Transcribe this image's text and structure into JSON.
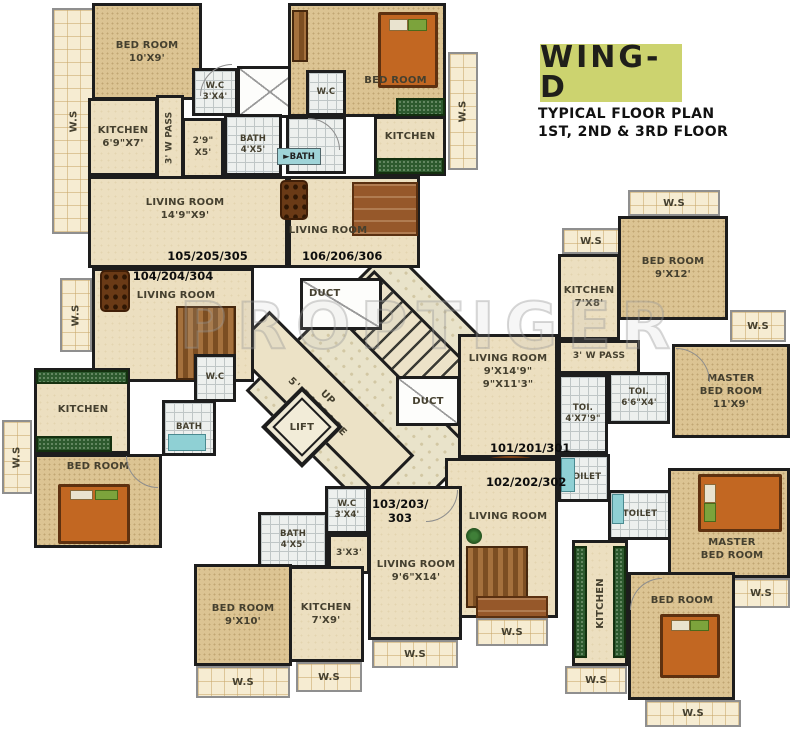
{
  "title": {
    "wing": "WING-D",
    "subtitle1": "TYPICAL FLOOR PLAN",
    "subtitle2": "1ST, 2ND & 3RD FLOOR",
    "accent_color": "#ccd36f"
  },
  "watermark": "PROPTIGER",
  "common": {
    "ws": "W.S"
  },
  "core": {
    "duct": "DUCT",
    "up": "UP",
    "passage": "5' PASSAGE",
    "lift": "LIFT"
  },
  "units": {
    "u105": {
      "id": "105/205/305",
      "bedroom": "BED ROOM\n10'X9'",
      "kitchen": "KITCHEN\n6'9\"X7'",
      "wpass": "3' W PASS",
      "store": "2'9\"\nX5'",
      "wc": "W.C\n3'X4'",
      "bath": "BATH\n4'X5'",
      "living": "LIVING ROOM\n14'9\"X9'"
    },
    "u106": {
      "id": "106/206/306",
      "bedroom": "BED ROOM",
      "wc": "W.C",
      "bath_tag": "►BATH",
      "kitchen": "KITCHEN",
      "living": "LIVING ROOM"
    },
    "u101": {
      "id": "101/201/301",
      "kitchen": "KITCHEN\n7'X8'",
      "bedroom": "BED ROOM\n9'X12'",
      "wpass": "3' W PASS",
      "master": "MASTER\nBED ROOM\n11'X9'",
      "toi_small": "TOI.\n6'6\"X4'",
      "toi_long": "TOI.\n4'X7'9\"",
      "living": "LIVING ROOM\n9'X14'9\"\n9\"X11'3\"",
      "toilet": "TOILET"
    },
    "u102": {
      "id": "102/202/302",
      "toilet": "TOILET",
      "master": "MASTER\nBED ROOM",
      "bedroom": "BED ROOM",
      "kitchen": "KITCHEN",
      "living": "LIVING ROOM"
    },
    "u103": {
      "id": "103/203/\n303",
      "wc": "W.C\n3'X4'",
      "bath": "BATH\n4'X5'",
      "store": "3'X3'",
      "living": "LIVING ROOM\n9'6\"X14'",
      "kitchen": "KITCHEN\n7'X9'"
    },
    "u104": {
      "id": "104/204/304",
      "living": "LIVING ROOM",
      "kitchen": "KITCHEN",
      "bath": "BATH",
      "wc": "W.C",
      "bedroom": "BED ROOM",
      "bedroom2": "BED ROOM\n9'X10'"
    }
  }
}
